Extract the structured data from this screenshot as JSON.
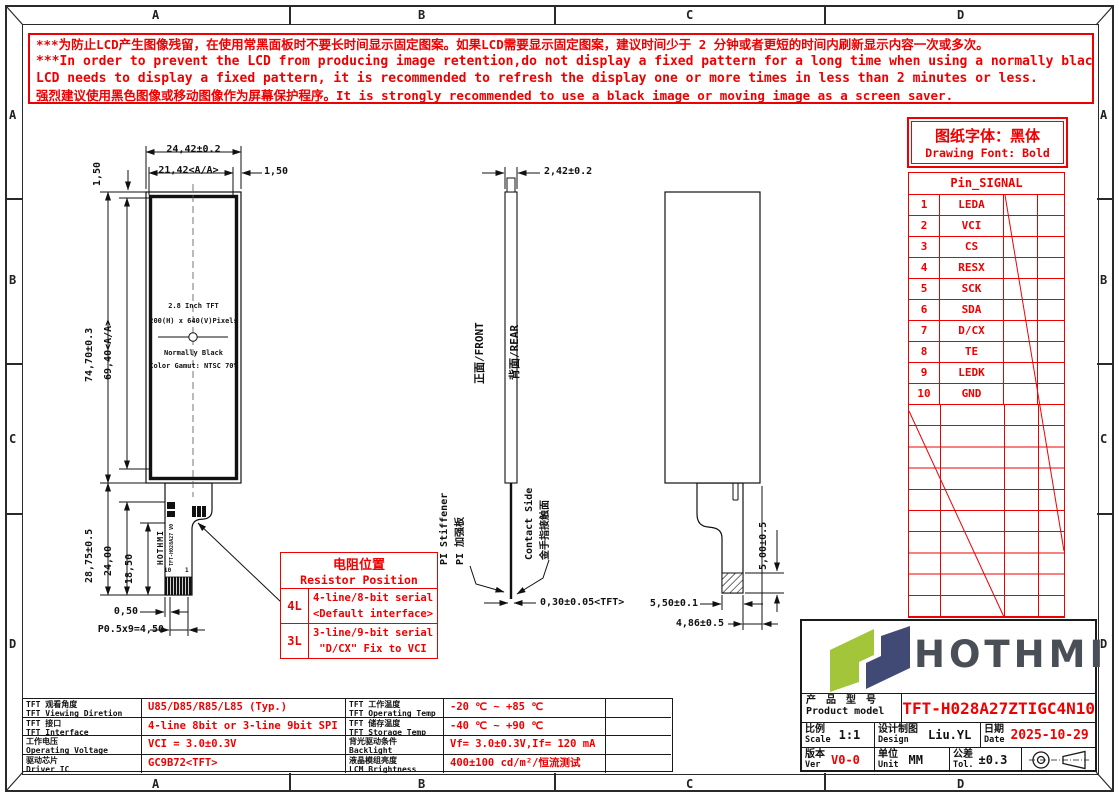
{
  "colors": {
    "red": "#ef0000",
    "black": "#1a1a1a",
    "logo_green": "#a3c53a",
    "logo_navy": "#414a75",
    "logo_text": "#4a4e57"
  },
  "zones": {
    "cols": [
      "A",
      "B",
      "C",
      "D"
    ],
    "rows": [
      "A",
      "B",
      "C",
      "D"
    ]
  },
  "warning": {
    "l1": "***为防止LCD产生图像残留，在使用常黑面板时不要长时间显示固定图案。如果LCD需要显示固定图案，建议时间少于 2 分钟或者更短的时间内刷新显示内容一次或多次。",
    "l2": "***In order to prevent the LCD from producing image retention,do not display a fixed pattern for a long time when using a normally black panel.If the",
    "l3": " LCD needs to display a fixed pattern, it is recommended to refresh the display one or more times in less than 2 minutes or less.",
    "l4": "强烈建议使用黑色图像或移动图像作为屏幕保护程序。It is strongly recommended to use a black image or moving image as a screen saver."
  },
  "font_note": {
    "cn": "图纸字体：黑体",
    "en": "Drawing Font: Bold"
  },
  "pin_table": {
    "title": "Pin_SIGNAL",
    "rows": [
      {
        "no": "1",
        "signal": "LEDA"
      },
      {
        "no": "2",
        "signal": "VCI"
      },
      {
        "no": "3",
        "signal": "CS"
      },
      {
        "no": "4",
        "signal": "RESX"
      },
      {
        "no": "5",
        "signal": "SCK"
      },
      {
        "no": "6",
        "signal": "SDA"
      },
      {
        "no": "7",
        "signal": "D/CX"
      },
      {
        "no": "8",
        "signal": "TE"
      },
      {
        "no": "9",
        "signal": "LEDK"
      },
      {
        "no": "10",
        "signal": "GND"
      }
    ]
  },
  "front_view": {
    "l1": "2.8 Inch TFT",
    "l2": "200(H) x 640(V)Pixels",
    "l3": "Normally Black",
    "l4": "Color Gamut: NTSC 70%",
    "fpc_brand": "HOTHMI",
    "fpc_model": "TFT-H028A27 V0",
    "pin_left": "10",
    "pin_right": "1"
  },
  "dims": {
    "front_width_total": "24,42±0.2",
    "front_width_aa": "21,42<A/A>",
    "front_margin_right": "1,50",
    "front_margin_top": "1,50",
    "front_height_total": "74,70±0.3",
    "front_height_aa": "69,40<A/A>",
    "tail_len": "28,75±0.5",
    "tail_24": "24,00",
    "tail_185": "18,50",
    "tail_050": "0,50",
    "pitch": "P0.5x9=4,50",
    "side_thickness": "2,42±0.2",
    "fpc_thickness": "0,30±0.05<TFT>",
    "rear_500": "5,00±0.5",
    "rear_550": "5,50±0.1",
    "rear_486": "4,86±0.5"
  },
  "side_view": {
    "front": "正面/FRONT",
    "rear": "背面/REAR",
    "pi_en": "PI Stiffener",
    "pi_cn": "PI 加强板",
    "contact_en": "Contact Side",
    "contact_cn": "金手指接触面"
  },
  "resistor_table": {
    "title_cn": "电阻位置",
    "title_en": "Resistor Position",
    "rows": [
      {
        "key": "4L",
        "line1": "4-line/8-bit serial",
        "line2": "<Default interface>"
      },
      {
        "key": "3L",
        "line1": "3-line/9-bit serial",
        "line2": "\"D/CX\" Fix to VCI"
      }
    ]
  },
  "spec_table": {
    "rows": [
      {
        "cn": "TFT 观看角度",
        "en": "TFT Viewing Diretion",
        "value": "U85/D85/R85/L85 (Typ.)"
      },
      {
        "cn": "TFT 接口",
        "en": "TFT Interface",
        "value": "4-line 8bit or 3-line 9bit SPI"
      },
      {
        "cn": "工作电压",
        "en": "Operating Voltage",
        "value": "VCI = 3.0±0.3V"
      },
      {
        "cn": "驱动芯片",
        "en": "Driver IC",
        "value": "GC9B72<TFT>"
      },
      {
        "cn": "TFT 工作温度",
        "en": "TFT Operating Temp",
        "value": "-20 ℃ ~ +85 ℃"
      },
      {
        "cn": "TFT 储存温度",
        "en": "TFT Storage Temp",
        "value": "-40 ℃ ~ +90 ℃"
      },
      {
        "cn": "背光驱动条件",
        "en": "Backlight conditions",
        "value": "Vf= 3.0±0.3V,If= 120 mA"
      },
      {
        "cn": "液晶模组亮度",
        "en": "LCM Brightness",
        "value": "400±100 cd/m²/恒流测试"
      }
    ]
  },
  "title_block": {
    "brand": "HOTHMI",
    "model_label_cn": "产 品 型 号",
    "model_label_en": "Product model",
    "model": "TFT-H028A27ZTIGC4N10",
    "scale_cn": "比例",
    "scale_en": "Scale",
    "scale": "1:1",
    "design_cn": "设计制图",
    "design_en": "Design",
    "design": "Liu.YL",
    "date_cn": "日期",
    "date_en": "Date",
    "date": "2025-10-29",
    "ver_cn": "版本",
    "ver_en": "Ver",
    "ver": "V0-0",
    "unit_cn": "单位",
    "unit_en": "Unit",
    "unit": "MM",
    "tol_cn": "公差",
    "tol_en": "Tol.",
    "tol": "±0.3"
  }
}
